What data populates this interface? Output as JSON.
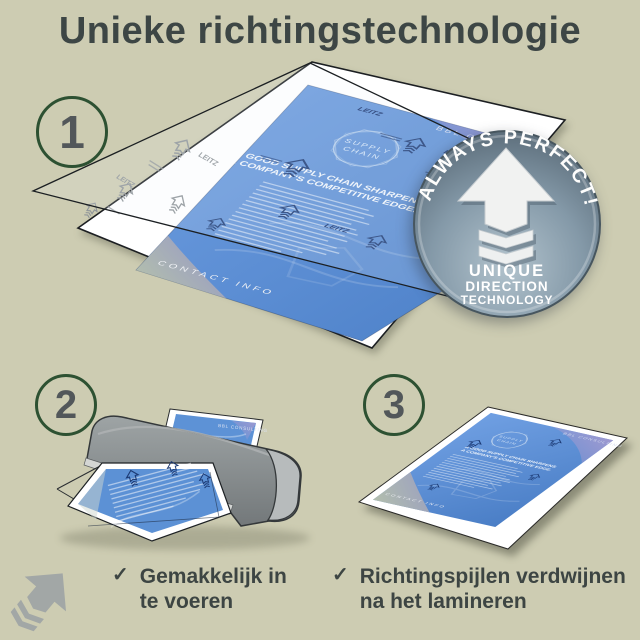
{
  "colors": {
    "background": "#cdccb2",
    "title_text": "#3d4645",
    "step_ring_green": "#2d5132",
    "badge_steel": "#8297a6",
    "document_blue": "#5b8fd3",
    "machine_gray": "#8b9193"
  },
  "title": {
    "text": "Unieke richtingstechnologie"
  },
  "steps": [
    {
      "number": "1"
    },
    {
      "number": "2"
    },
    {
      "number": "3"
    }
  ],
  "badge": {
    "arc_text": "ALWAYS PERFECT!",
    "lines": [
      "UNIQUE",
      "DIRECTION",
      "TECHNOLOGY"
    ]
  },
  "sample_document": {
    "brand": "LEITZ",
    "company": "BBL CONSULTING",
    "emblem": [
      "SUPPLY",
      "CHAIN"
    ],
    "headline": [
      "A GOOD SUPPLY CHAIN SHARPENS",
      "A COMPANY'S COMPETITIVE EDGE."
    ],
    "footer": "CONTACT INFO"
  },
  "captions": [
    {
      "check": "✓",
      "lines": [
        "Gemakkelijk in",
        "te voeren"
      ]
    },
    {
      "check": "✓",
      "lines": [
        "Richtingspijlen verdwijnen",
        "na het lamineren"
      ]
    }
  ]
}
